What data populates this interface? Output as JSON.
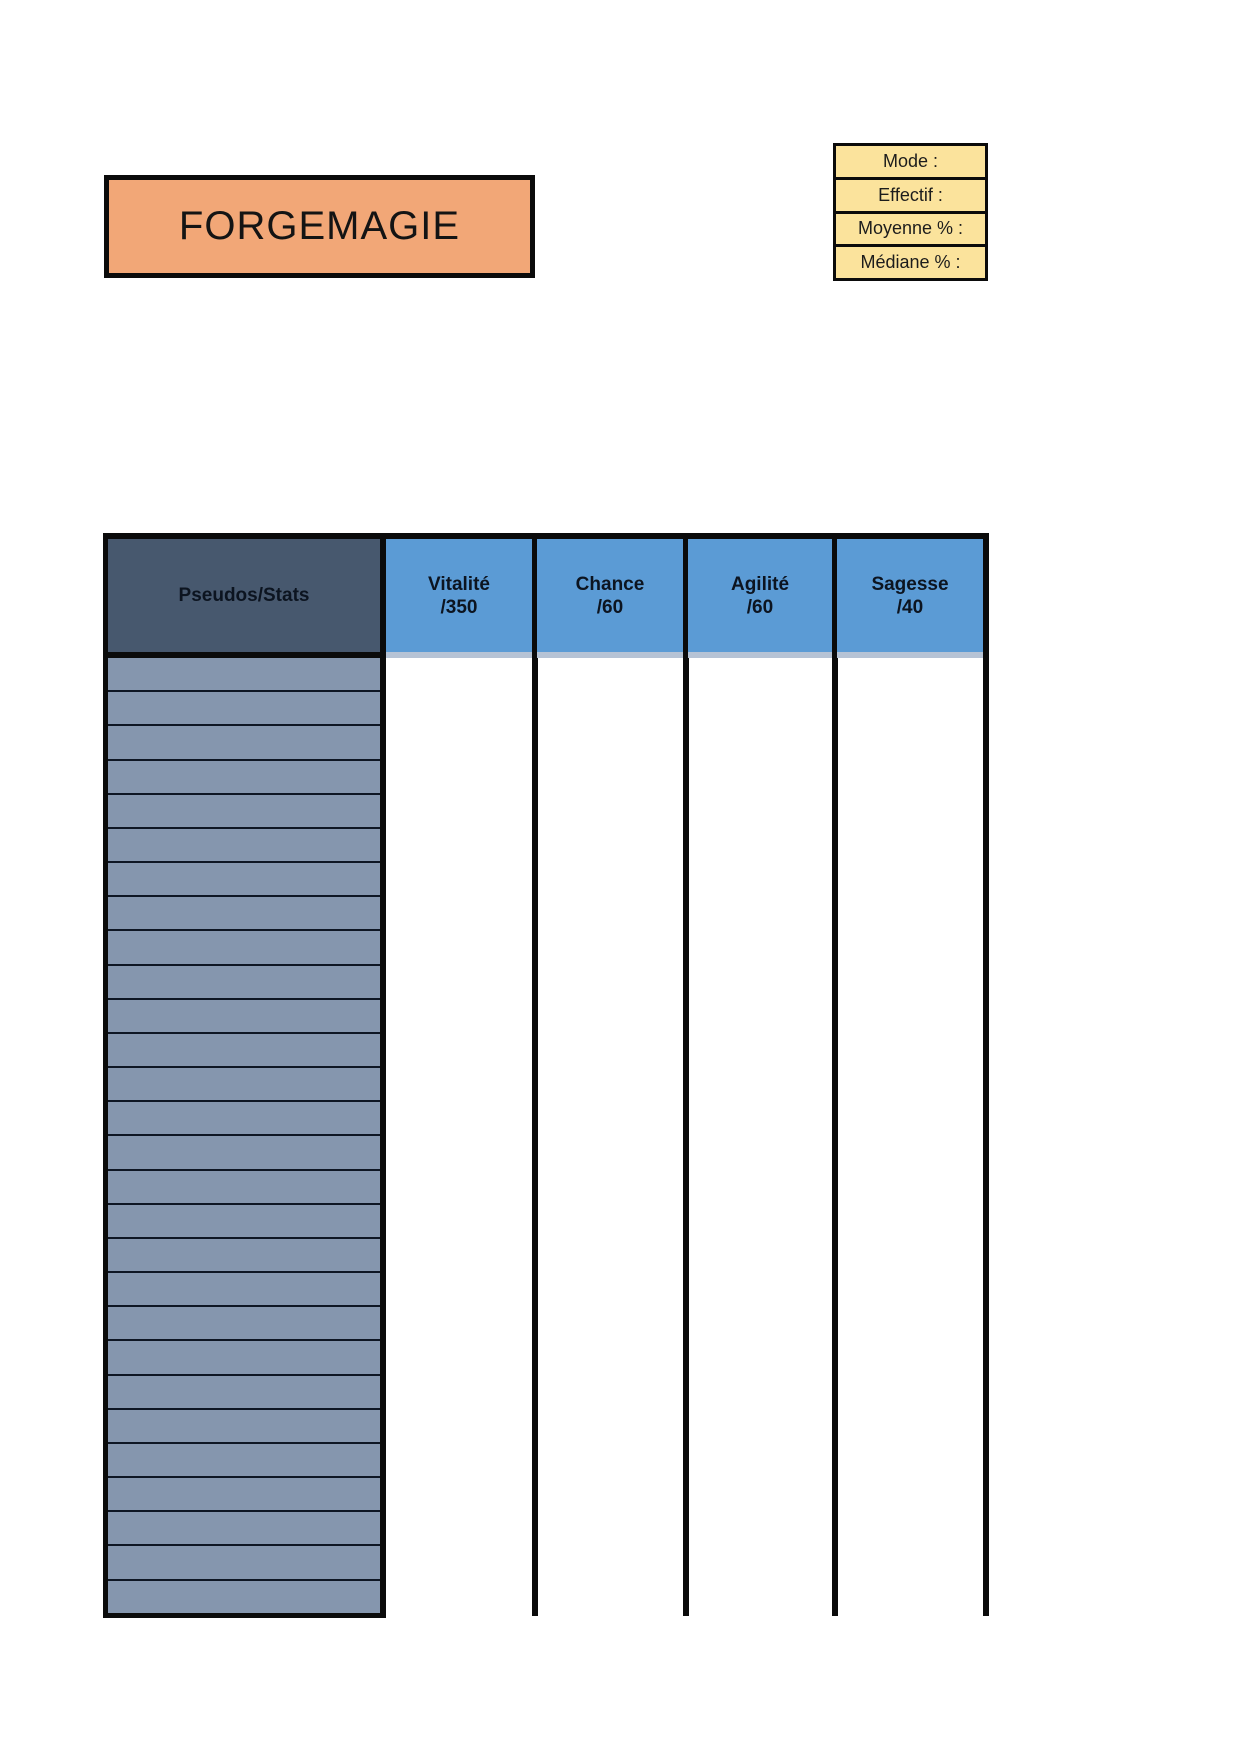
{
  "title_box": {
    "label": "FORGEMAGIE"
  },
  "stats_panel": {
    "rows": [
      {
        "label": "Mode :"
      },
      {
        "label": "Effectif :"
      },
      {
        "label": "Moyenne % :"
      },
      {
        "label": "Médiane % :"
      }
    ]
  },
  "table": {
    "corner_header": "Pseudos/Stats",
    "columns": [
      {
        "label": "Vitalité",
        "max": "/350"
      },
      {
        "label": "Chance",
        "max": "/60"
      },
      {
        "label": "Agilité",
        "max": "/60"
      },
      {
        "label": "Sagesse",
        "max": "/40"
      }
    ],
    "pseudo_rows": 28,
    "data_cells": "empty"
  },
  "colors": {
    "title_bg": "#F2A777",
    "stats_bg": "#FBE39C",
    "corner_bg": "#47586E",
    "column_header_bg": "#5B9BD5",
    "row_bg": "#8596AE",
    "border": "#0B0B0B"
  }
}
